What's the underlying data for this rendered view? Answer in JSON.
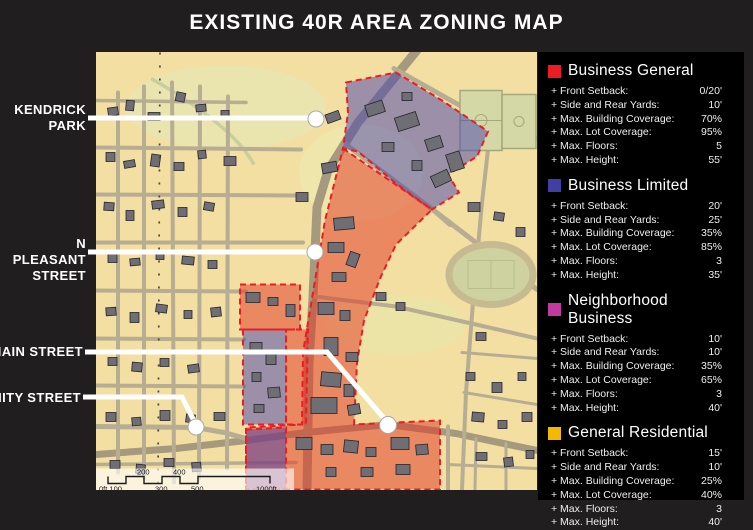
{
  "title": "EXISTING 40R AREA ZONING MAP",
  "map_labels": {
    "kendrick_park": {
      "line1": "KENDRICK",
      "line2": "PARK"
    },
    "n_pleasant_street": {
      "line1": "N PLEASANT",
      "line2": "STREET"
    },
    "main_street": {
      "label": "MAIN STREET"
    },
    "amity_street": {
      "label": "AMITY STREET"
    }
  },
  "legend": {
    "sections": [
      {
        "name": "Business General",
        "color": "#ec1c24",
        "rows": [
          {
            "label": "+ Front Setback:",
            "value": "0/20'"
          },
          {
            "label": "+ Side and Rear Yards:",
            "value": "10'"
          },
          {
            "label": "+ Max. Building Coverage:",
            "value": "70%"
          },
          {
            "label": "+ Max. Lot Coverage:",
            "value": "95%"
          },
          {
            "label": "+ Max. Floors:",
            "value": "5"
          },
          {
            "label": "+ Max. Height:",
            "value": "55'"
          }
        ]
      },
      {
        "name": "Business Limited",
        "color": "#3f3fa4",
        "rows": [
          {
            "label": "+ Front Setback:",
            "value": "20'"
          },
          {
            "label": "+ Side and Rear Yards:",
            "value": "25'"
          },
          {
            "label": "+ Max. Building Coverage:",
            "value": "35%"
          },
          {
            "label": "+ Max. Lot Coverage:",
            "value": "85%"
          },
          {
            "label": "+ Max. Floors:",
            "value": "3"
          },
          {
            "label": "+ Max. Height:",
            "value": "35'"
          }
        ]
      },
      {
        "name": "Neighborhood Business",
        "color": "#c13a9e",
        "rows": [
          {
            "label": "+ Front Setback:",
            "value": "10'"
          },
          {
            "label": "+ Side and Rear Yards:",
            "value": "10'"
          },
          {
            "label": "+ Max. Building Coverage:",
            "value": "35%"
          },
          {
            "label": "+ Max. Lot Coverage:",
            "value": "65%"
          },
          {
            "label": "+ Max. Floors:",
            "value": "3"
          },
          {
            "label": "+ Max. Height:",
            "value": "40'"
          }
        ]
      },
      {
        "name": "General Residential",
        "color": "#f5b800",
        "rows": [
          {
            "label": "+ Front Setback:",
            "value": "15'"
          },
          {
            "label": "+ Side and Rear Yards:",
            "value": "10'"
          },
          {
            "label": "+ Max. Building Coverage:",
            "value": "25%"
          },
          {
            "label": "+ Max. Lot Coverage:",
            "value": "40%"
          },
          {
            "label": "+ Max. Floors:",
            "value": "3"
          },
          {
            "label": "+ Max. Height:",
            "value": "40'"
          }
        ]
      }
    ]
  },
  "scale_bar": {
    "labels": [
      "0ft 100",
      "200",
      "300",
      "400",
      "500",
      "1000ft"
    ]
  }
}
